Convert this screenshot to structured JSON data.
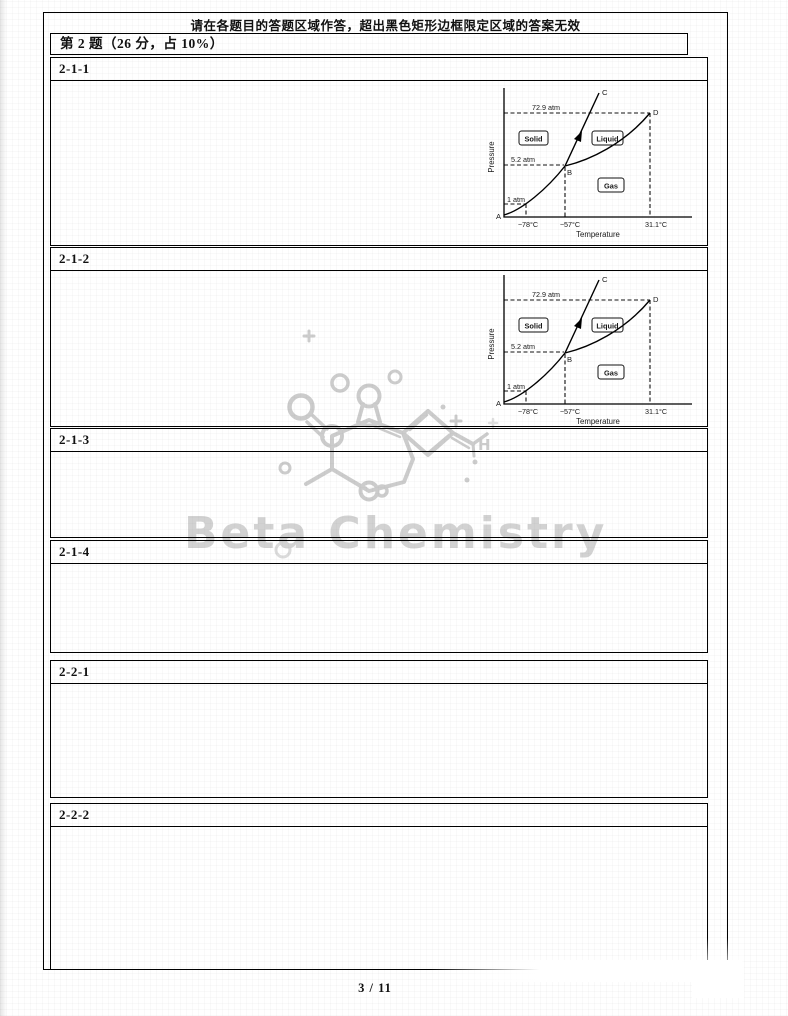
{
  "page": {
    "notice": "请在各题目的答题区域作答，超出黑色矩形边框限定区域的答案无效",
    "question_title": "第 2 题（26 分，占 10%）",
    "page_indicator": "3 / 11"
  },
  "watermark": {
    "text": "Beta Chemistry",
    "icon": "molecule-structure-icon",
    "color": "#d2d2d2"
  },
  "sections": [
    {
      "label": "2-1-1",
      "content": "phase-diagram"
    },
    {
      "label": "2-1-2",
      "content": "phase-diagram"
    },
    {
      "label": "2-1-3",
      "content": "empty-answer-area"
    },
    {
      "label": "2-1-4",
      "content": "empty-answer-area"
    },
    {
      "label": "2-2-1",
      "content": "empty-answer-area"
    },
    {
      "label": "2-2-2",
      "content": "empty-answer-area"
    }
  ],
  "diagram": {
    "ylabel": "Pressure",
    "xlabel": "Temperature",
    "y_ticks": {
      "p729": "72.9 atm",
      "p52": "5.2 atm",
      "p1": "1 atm"
    },
    "x_ticks": {
      "t78": "−78°C",
      "t57": "−57°C",
      "t311": "31.1°C"
    },
    "regions": {
      "solid": "Solid",
      "liquid": "Liquid",
      "gas": "Gas"
    },
    "points": {
      "a": "A",
      "b": "B",
      "c": "C",
      "d": "D"
    },
    "chart_data": {
      "type": "line",
      "title": "",
      "xlabel": "Temperature",
      "ylabel": "Pressure",
      "x_tick_values_c": [
        -78,
        -57,
        31.1
      ],
      "y_tick_values_atm": [
        1,
        5.2,
        72.9
      ],
      "grid": false,
      "series": [
        {
          "name": "sublimation curve A-B",
          "points_t_c_p_atm": [
            [
              -90,
              0.2
            ],
            [
              -78,
              1
            ],
            [
              -57,
              5.2
            ]
          ]
        },
        {
          "name": "fusion curve B-C",
          "points_t_c_p_atm": [
            [
              -57,
              5.2
            ],
            [
              -30,
              72.9
            ],
            [
              -20,
              95
            ]
          ],
          "note": "values above 5.2 atm estimated from drawing; arrow drawn on this segment"
        },
        {
          "name": "vaporization curve B-D",
          "points_t_c_p_atm": [
            [
              -57,
              5.2
            ],
            [
              0,
              25
            ],
            [
              31.1,
              72.9
            ]
          ]
        }
      ],
      "key_points": [
        {
          "label": "A",
          "t_c": -90,
          "p_atm": 0.2,
          "note": "origin end of sublimation curve, estimated"
        },
        {
          "label": "B",
          "t_c": -57,
          "p_atm": 5.2
        },
        {
          "label": "C",
          "t_c": -20,
          "p_atm": 95,
          "note": "upper end of fusion curve, estimated"
        },
        {
          "label": "D",
          "t_c": 31.1,
          "p_atm": 72.9
        }
      ],
      "regions": [
        "Solid",
        "Liquid",
        "Gas"
      ],
      "dashed_guides": [
        "72.9 atm to D",
        "5.2 atm to B",
        "1 atm at −78°C",
        "verticals at −78°C, −57°C, 31.1°C"
      ]
    }
  },
  "colors": {
    "border": "#000000",
    "text": "#111111",
    "watermark": "#cccccc"
  }
}
